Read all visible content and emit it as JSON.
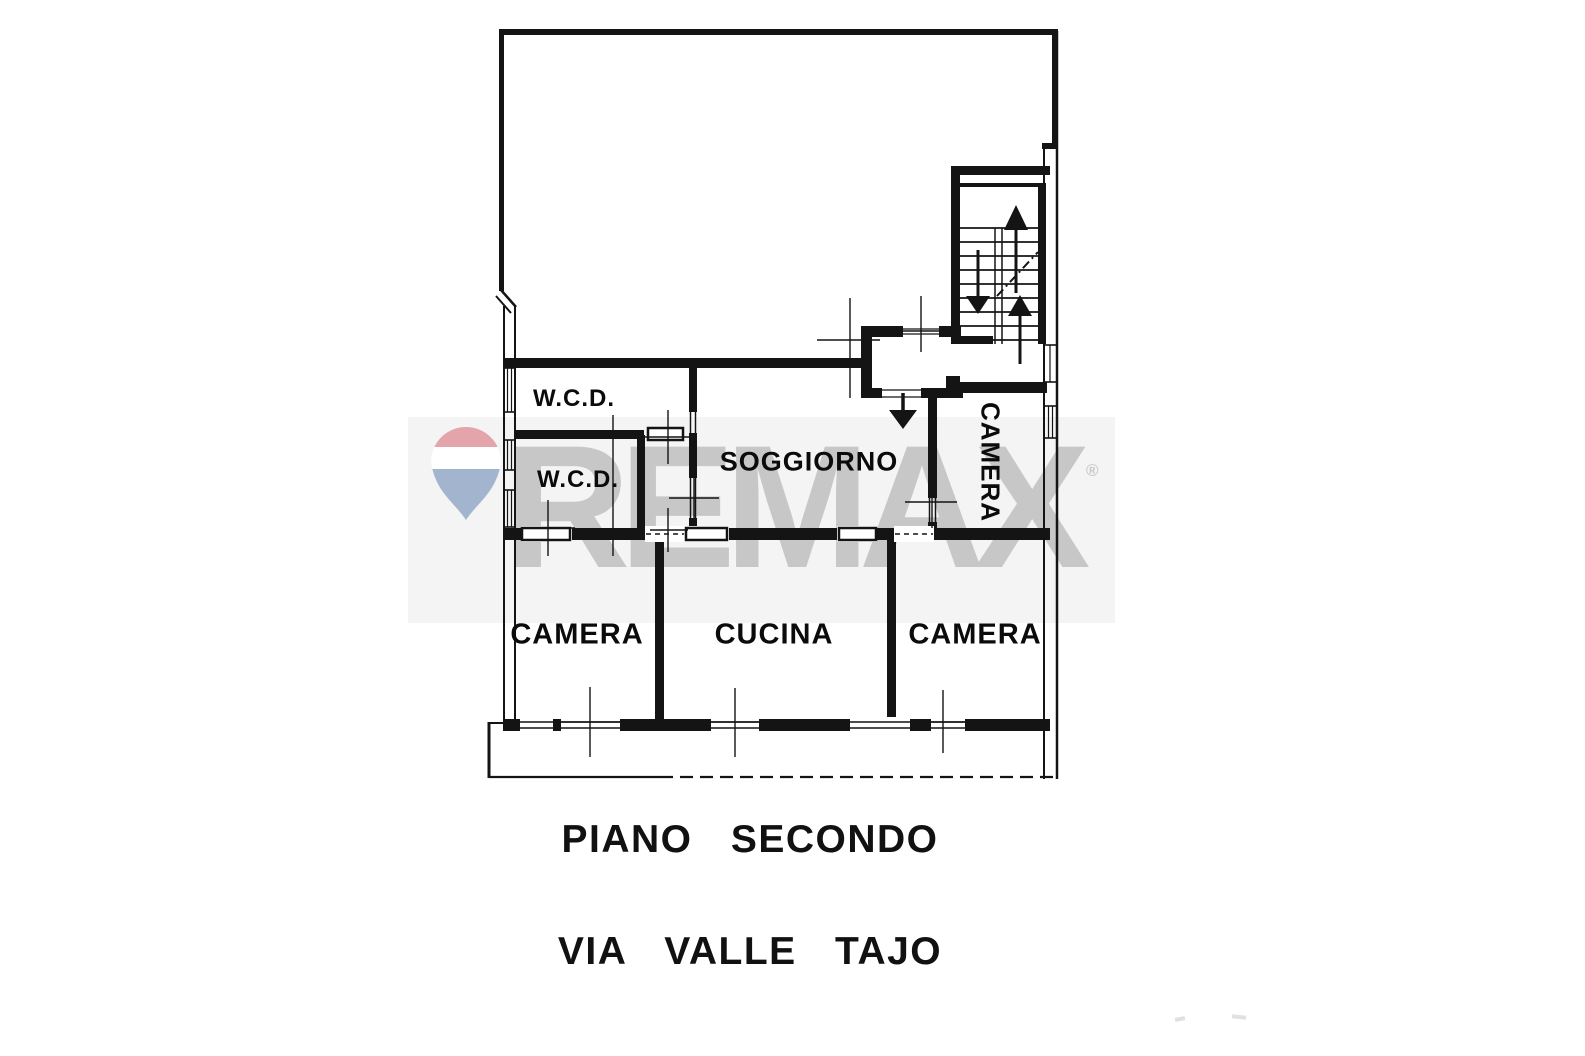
{
  "watermark": {
    "brand": "REMAX",
    "registered": "®",
    "text_color": "#c7c7c7",
    "panel_color": "#f4f4f4",
    "balloon_red": "#d45463",
    "balloon_white": "#ffffff",
    "balloon_blue": "#41699f"
  },
  "floorplan": {
    "line_color": "#141414",
    "rooms": {
      "wcd_upper": "W.C.D.",
      "wcd_lower": "W.C.D.",
      "soggiorno": "SOGGIORNO",
      "camera_middle": "CAMERA",
      "camera_left": "CAMERA",
      "cucina": "CUCINA",
      "camera_right": "CAMERA"
    },
    "icons": {
      "stairs_up_arrow": "filled-triangle-up",
      "stairs_down_arrow": "filled-triangle-down",
      "entrance_arrow": "filled-triangle-down"
    }
  },
  "captions": {
    "floor": "PIANO SECONDO",
    "street": "VIA VALLE TAJO"
  }
}
